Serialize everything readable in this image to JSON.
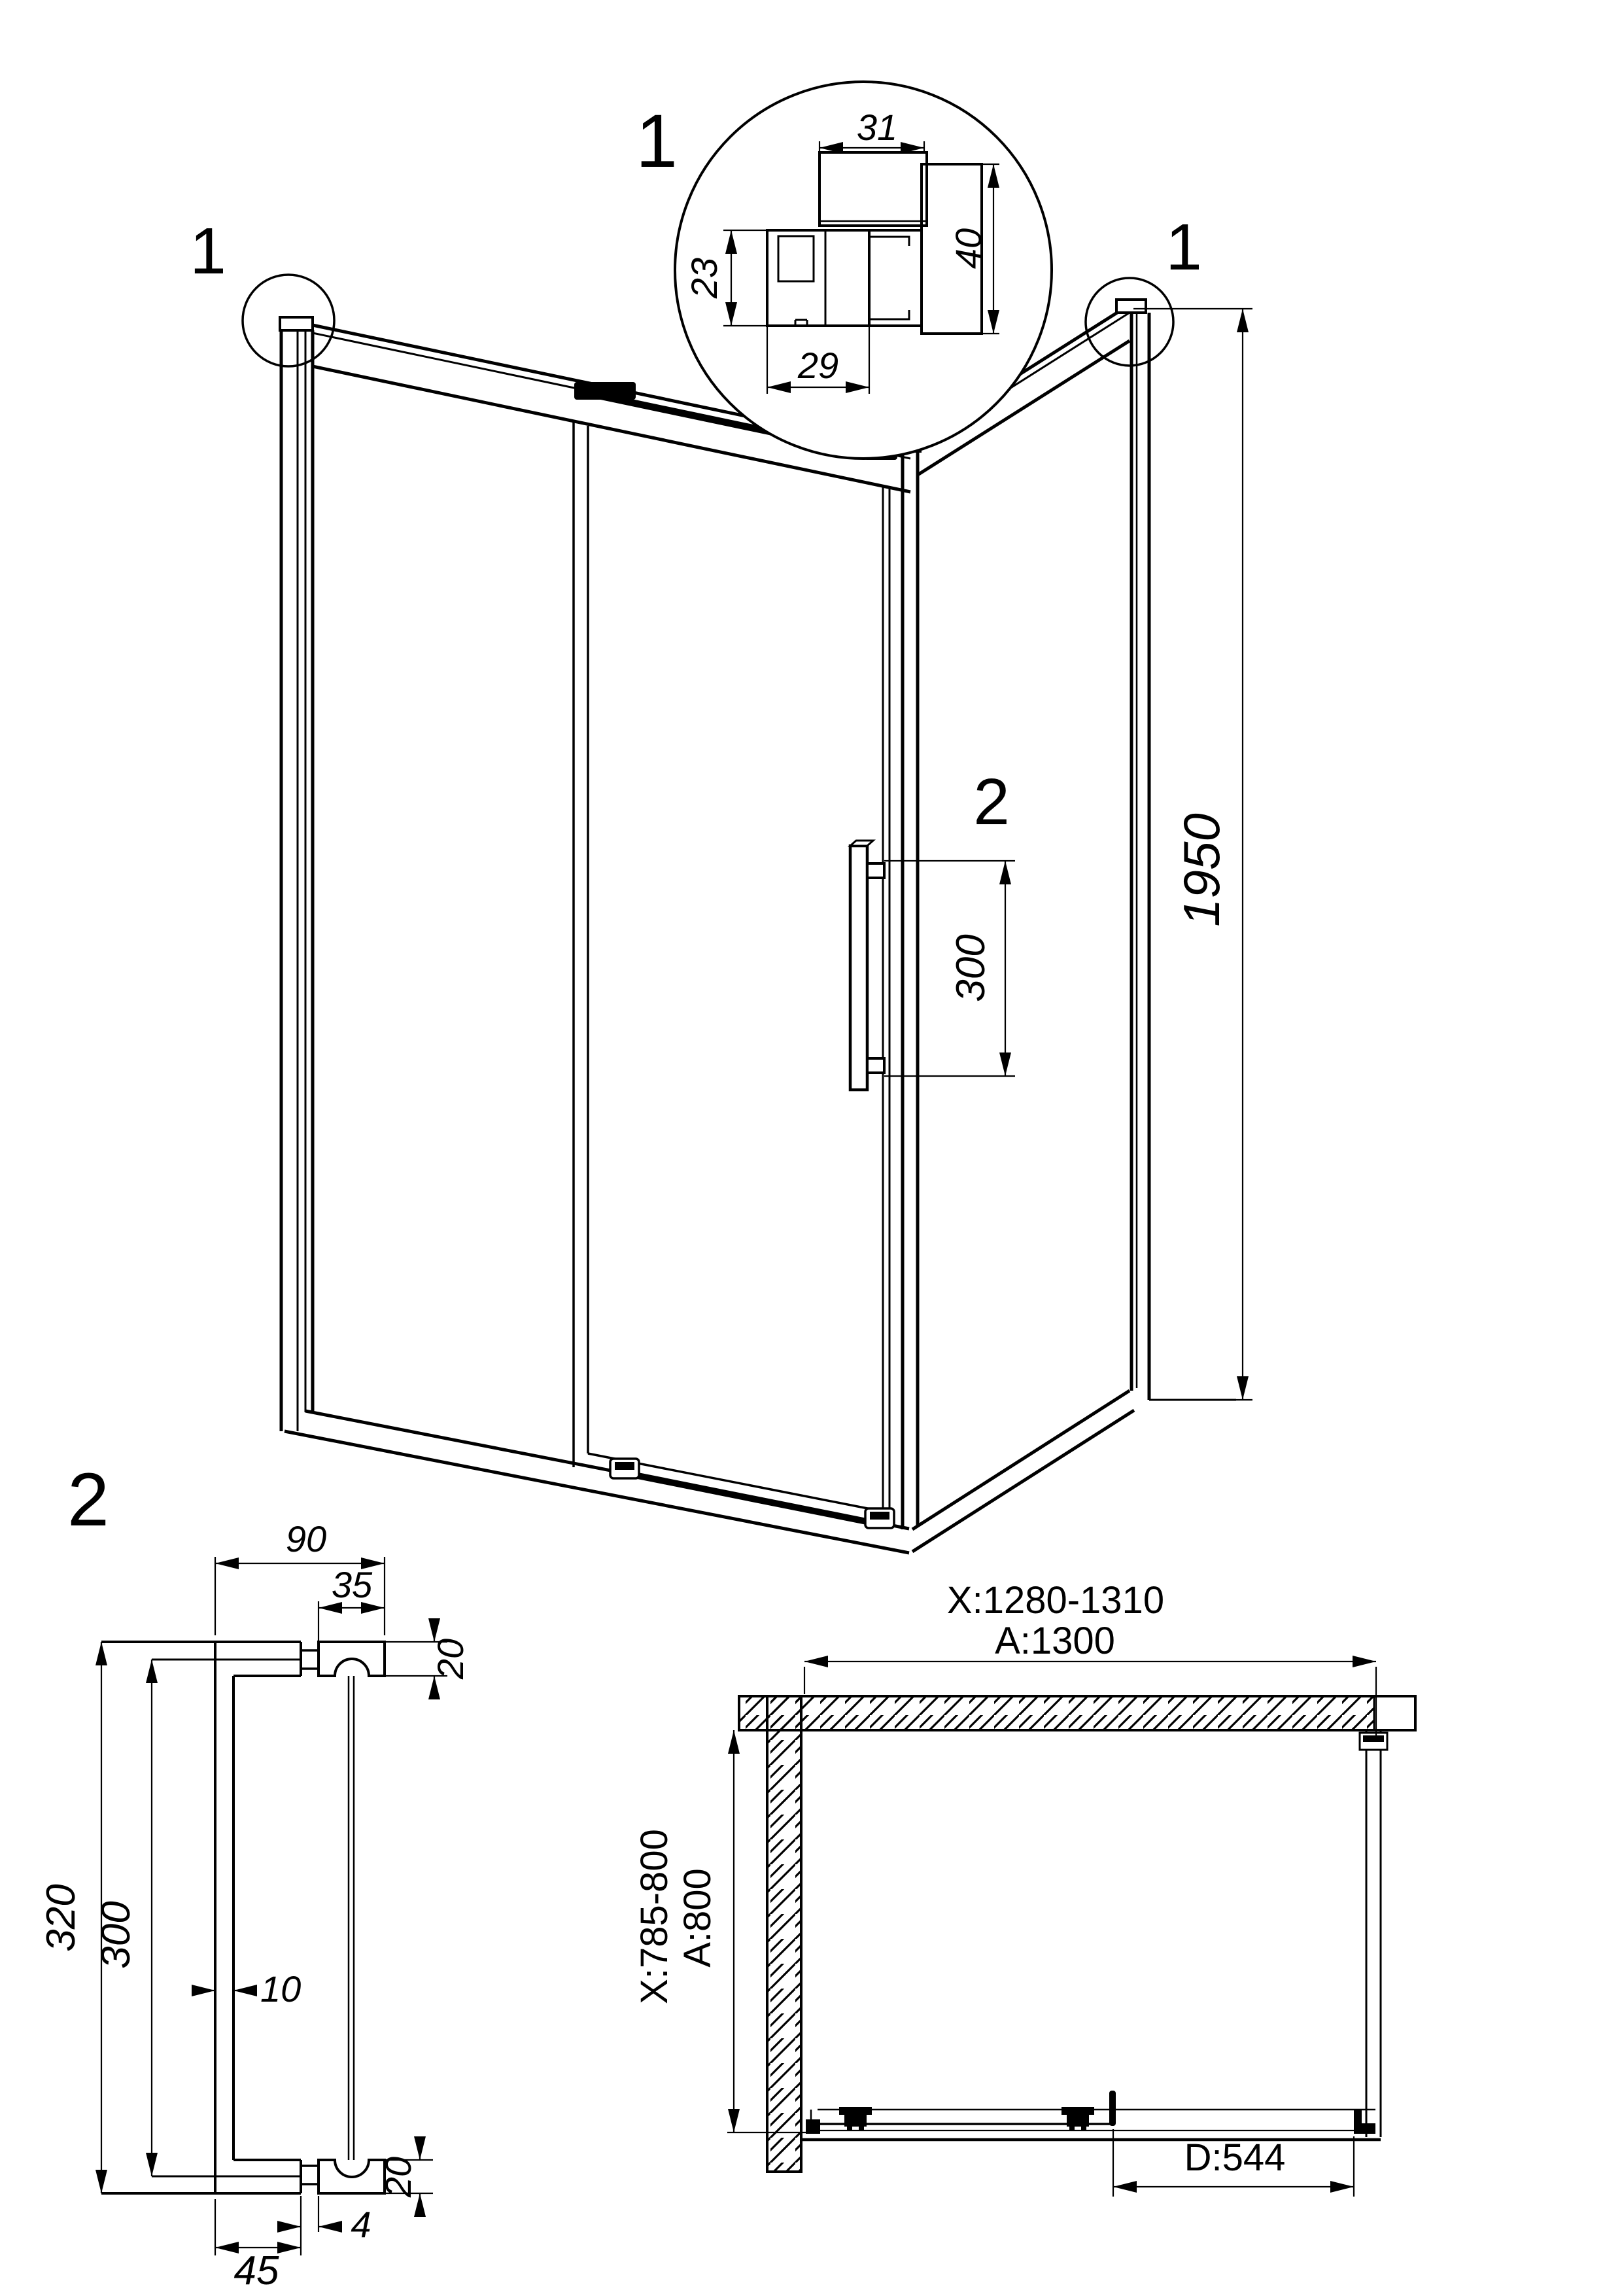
{
  "drawing_title": "corner shower enclosure with sliding door - technical drawing",
  "colors": {
    "line": "#000000",
    "background": "#ffffff"
  },
  "labels": {
    "detail1": "1",
    "corner_left": "1",
    "corner_right": "1",
    "handle_callout": "2",
    "detail2": "2"
  },
  "detail1": {
    "dims": {
      "top_width": "31",
      "left_height": "23",
      "bottom_width": "29",
      "right_height": "40"
    }
  },
  "view3d": {
    "dims": {
      "height": "1950",
      "handle_spacing": "300"
    }
  },
  "detail2": {
    "dims": {
      "depth": "90",
      "mount_width": "35",
      "mount_height_top": "20",
      "length_overall": "320",
      "length_centers": "300",
      "bar_thickness": "10",
      "stem": "4",
      "foot": "45",
      "mount_height_bottom": "20"
    }
  },
  "plan": {
    "dims": {
      "width_range": "X:1280-1310",
      "width": "A:1300",
      "depth_range": "X:785-800",
      "depth": "A:800",
      "door_width": "D:544"
    }
  }
}
